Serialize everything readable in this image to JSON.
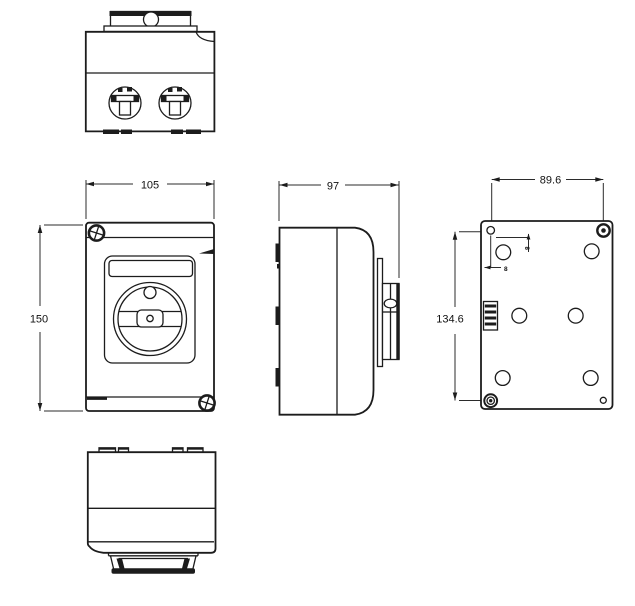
{
  "meta": {
    "background": "#ffffff",
    "line_color": "#1c1c1c",
    "dimension_color": "#2b2b2b"
  },
  "dimensions": {
    "front_width": "105",
    "front_height": "150",
    "side_depth": "97",
    "back_mount_width": "89.6",
    "back_mount_height": "134.6",
    "back_offset_top": "8",
    "back_offset_left": "8"
  }
}
